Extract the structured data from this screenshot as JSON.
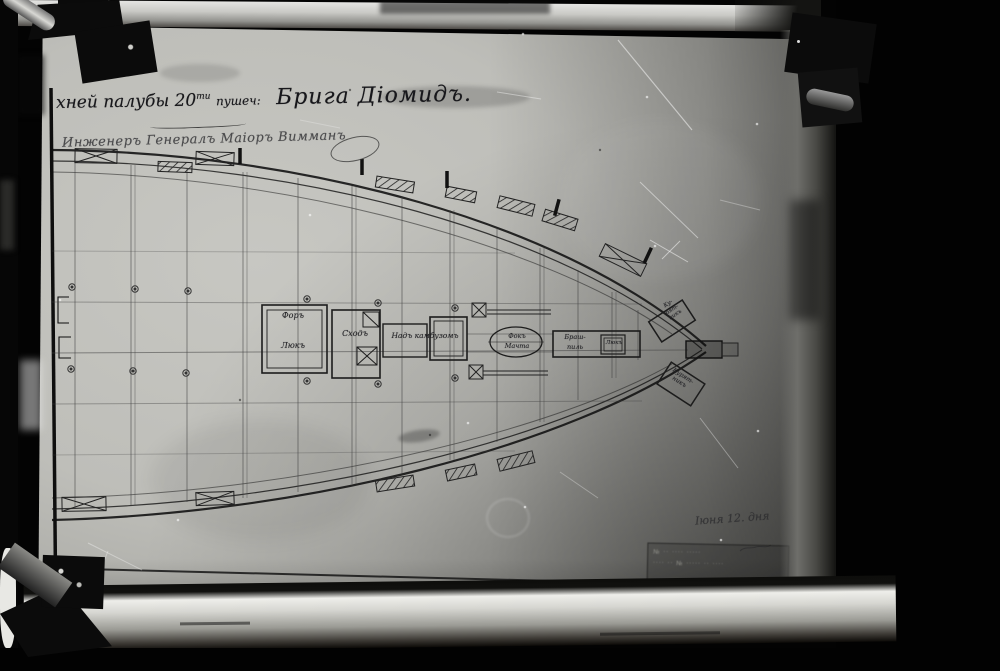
{
  "title": {
    "line1_prefix": "хней палубы",
    "gun_count": "20",
    "gun_sup": "ти",
    "line1_mid": "пушеч:",
    "ship_name": "Брига Діомидъ.",
    "line2": "Инженеръ Генералъ Маіоръ Вимманъ"
  },
  "plan_labels": {
    "fore_hatch_line1": "Форъ",
    "fore_hatch_line2": "Люкъ",
    "companionway": "Сходъ",
    "galley_hatch": "Надъ камбузомъ",
    "fore_mast_line1": "Фокъ",
    "fore_mast_line2": "Мачта",
    "windlass_line1": "Браш-",
    "windlass_line2": "пиль",
    "windlass_hatch": "Люкъ",
    "coop_top_line1": "Ку-",
    "coop_top_line2": "рят-",
    "coop_top_line3": "никъ",
    "coop_bottom_line1": "Курят-",
    "coop_bottom_line2": "никъ"
  },
  "annotations": {
    "date_note": "Іюня 12. дня",
    "stamp_line1": "№ ·· ···· ·····",
    "stamp_line2": "···· ·· № ····· ·· ····"
  },
  "colors": {
    "paper": "#bebeb9",
    "ink": "#1c1c1c",
    "frame_light": "#d9d9d6",
    "background": "#030303"
  }
}
